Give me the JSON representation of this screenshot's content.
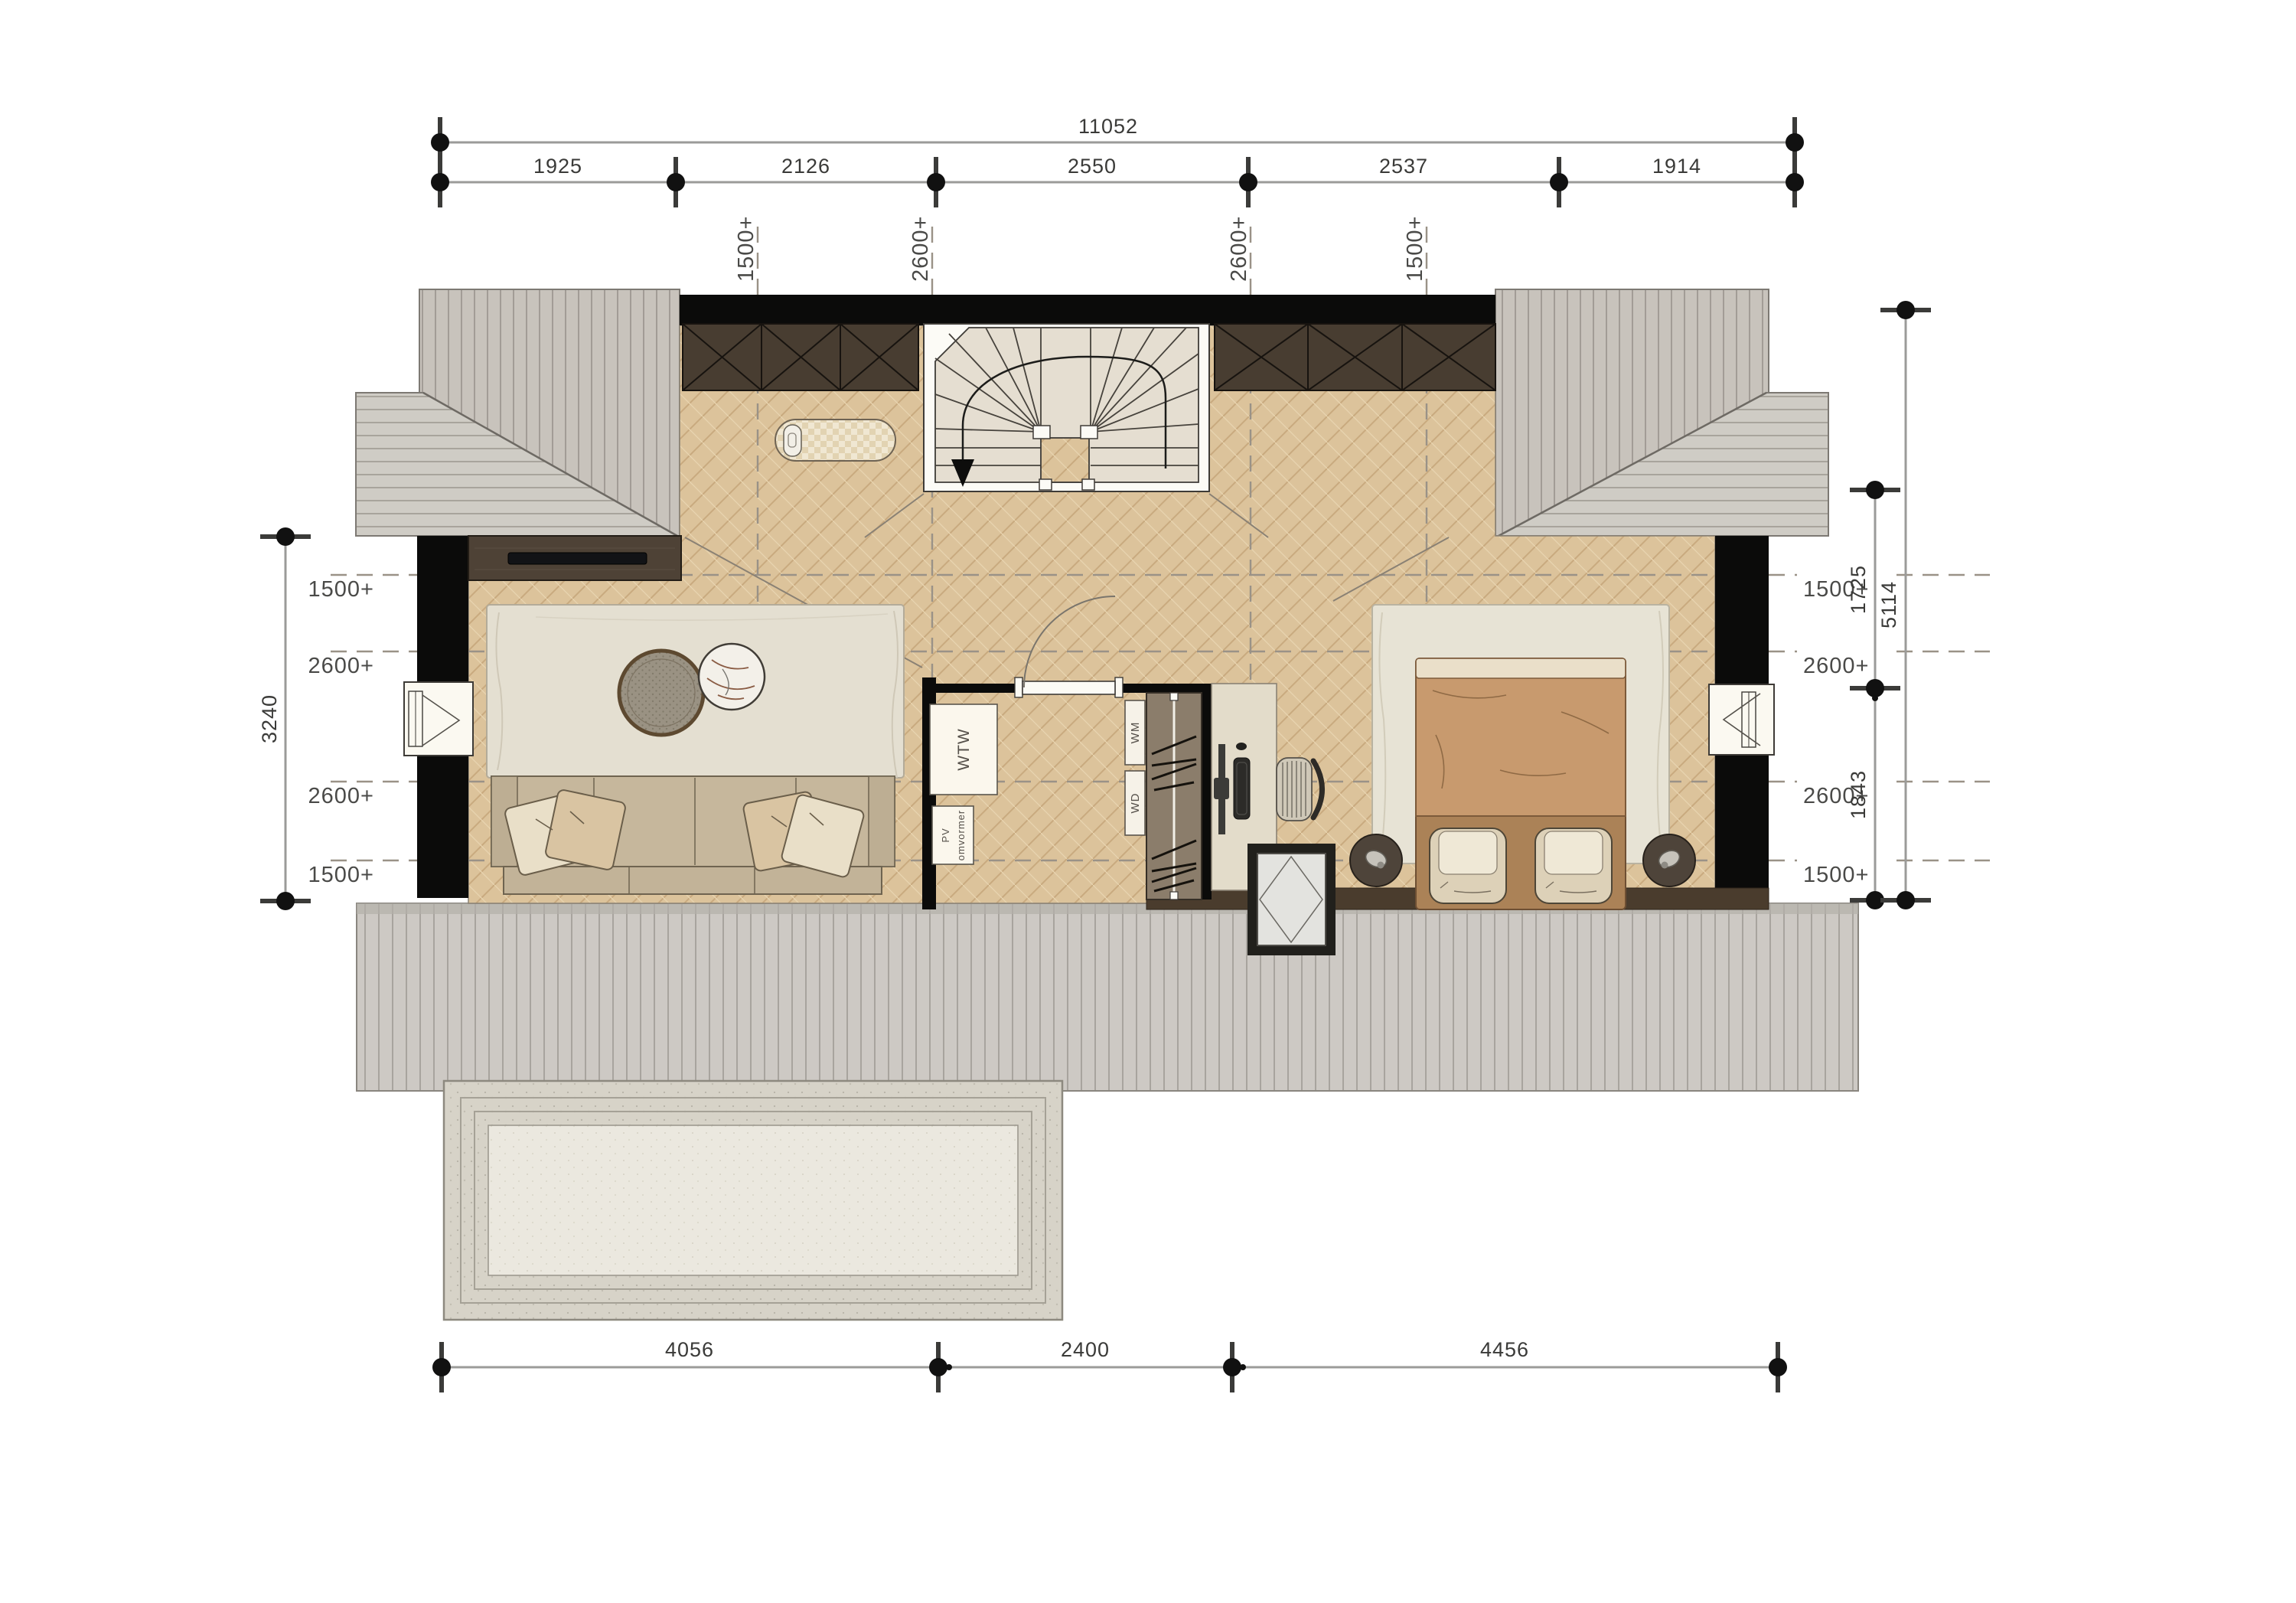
{
  "plan": {
    "dims": {
      "top_total": "11052",
      "top_segments": [
        "1925",
        "2126",
        "2550",
        "2537",
        "1914"
      ],
      "bottom_segments": [
        "4056",
        "2400",
        "4456"
      ],
      "left_total": "3240",
      "right_segments": [
        "1725",
        "1843"
      ],
      "right_total": "5114"
    },
    "levels": {
      "top": [
        "1500+",
        "2600+",
        "2600+",
        "1500+"
      ],
      "left": [
        "1500+",
        "2600+",
        "2600+",
        "1500+"
      ],
      "right": [
        "1500+",
        "2600+",
        "2600+",
        "1500+"
      ]
    },
    "equipment": {
      "wtw": "WTW",
      "pv_line1": "PV",
      "pv_line2": "omvormer",
      "wm": "WM",
      "wd": "WD"
    },
    "colors": {
      "wall": "#0b0b0a",
      "roof": "#c8c3bc",
      "floor_wood": "#dcc39b",
      "closet": "#483d31",
      "stair": "#e5ded1"
    }
  }
}
